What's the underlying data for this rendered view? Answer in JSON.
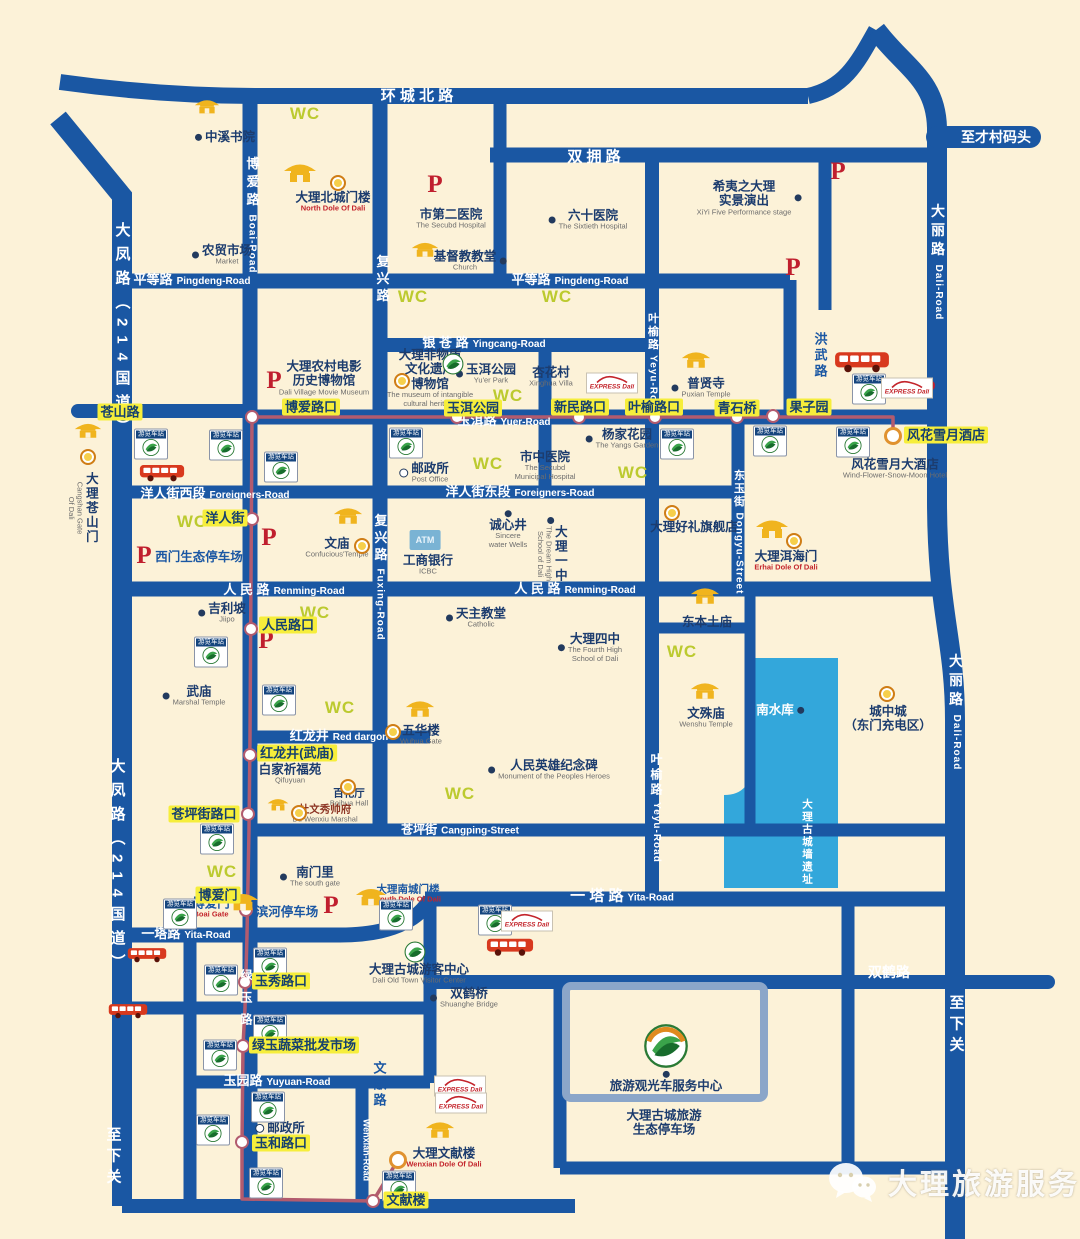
{
  "map": {
    "colors": {
      "bg": "#fcf2d8",
      "road": "#1a57a3",
      "water": "#33a7db",
      "route": "#b25b6e",
      "outline": "#8ba6c9",
      "stop_bg": "#f6ee3b",
      "stop_text": "#15406e",
      "poi": "#1c3c6e",
      "wc": "#bcca2f",
      "p": "#c01f2e",
      "gate": "#f0b41e",
      "blue_label": "#1a57a3"
    },
    "watermark": {
      "text": "大理旅游服务"
    },
    "wc_text": "WC",
    "p_text": "P",
    "atm_text": "ATM",
    "badge_text": "游览车站",
    "express_text": "EXPRESS Dali",
    "road_labels": [
      {
        "t": "环 城 北 路",
        "x": 417,
        "y": 96,
        "fs": 15
      },
      {
        "t": "双 拥 路",
        "x": 594,
        "y": 157,
        "fs": 15
      },
      {
        "t": "平等路",
        "e": "Pingdeng-Road",
        "x": 192,
        "y": 280,
        "fs": 13
      },
      {
        "t": "平等路",
        "e": "Pingdeng-Road",
        "x": 570,
        "y": 280,
        "fs": 13
      },
      {
        "t": "银 苍 路",
        "e": "Yingcang-Road",
        "x": 484,
        "y": 343,
        "fs": 13
      },
      {
        "t": "玉洱路",
        "e": "Yuer-Road",
        "x": 504,
        "y": 421,
        "fs": 13
      },
      {
        "t": "洋人街西段",
        "e": "Foreigners-Road",
        "x": 215,
        "y": 494,
        "fs": 13
      },
      {
        "t": "洋人街东段",
        "e": "Foreigners-Road",
        "x": 520,
        "y": 492,
        "fs": 13
      },
      {
        "t": "人 民 路",
        "e": "Renming-Road",
        "x": 284,
        "y": 590,
        "fs": 13
      },
      {
        "t": "人 民 路",
        "e": "Renming-Road",
        "x": 575,
        "y": 589,
        "fs": 13
      },
      {
        "t": "红龙井",
        "e": "Red dargon",
        "x": 339,
        "y": 736,
        "fs": 13
      },
      {
        "t": "苍坪街",
        "e": "Cangping-Street",
        "x": 460,
        "y": 830,
        "fs": 12
      },
      {
        "t": "一塔路",
        "e": "Yita-Road",
        "x": 186,
        "y": 934,
        "fs": 13
      },
      {
        "t": "一 塔 路",
        "e": "Yita-Road",
        "x": 622,
        "y": 896,
        "fs": 15
      },
      {
        "t": "双鹤路",
        "x": 889,
        "y": 972,
        "fs": 14
      },
      {
        "t": "玉园路",
        "e": "Yuyuan-Road",
        "x": 277,
        "y": 1081,
        "fs": 13
      },
      {
        "t": "至才村码头",
        "x": 996,
        "y": 137,
        "fs": 14
      },
      {
        "t": "博爱路",
        "e": "Boai-Road",
        "x": 252,
        "y": 215,
        "v": 1,
        "fs": 13,
        "ls": 5
      },
      {
        "t": "复兴路",
        "x": 382,
        "y": 280,
        "v": 1,
        "fs": 13,
        "ls": 4
      },
      {
        "t": "复兴路",
        "e": "Fuxing-Road",
        "x": 380,
        "y": 577,
        "v": 1,
        "fs": 13,
        "ls": 4
      },
      {
        "t": "叶榆路",
        "e": "Yeyu-Road",
        "x": 652,
        "y": 364,
        "v": 1,
        "fs": 11,
        "ls": 2
      },
      {
        "t": "叶榆路",
        "e": "Yeyu-Road",
        "x": 656,
        "y": 808,
        "v": 1,
        "fs": 12,
        "ls": 3
      },
      {
        "t": "东玉街",
        "e": "Dongyu-Street",
        "x": 738,
        "y": 532,
        "v": 1,
        "fs": 11,
        "ls": 2
      },
      {
        "t": "大丽路",
        "e": "Dali-Road",
        "x": 938,
        "y": 262,
        "v": 1,
        "fs": 14,
        "ls": 5
      },
      {
        "t": "大丽路",
        "e": "Dali-Road",
        "x": 956,
        "y": 712,
        "v": 1,
        "fs": 14,
        "ls": 5
      },
      {
        "t": "大凤路（214国道）",
        "x": 122,
        "y": 332,
        "v": 1,
        "fs": 15,
        "ls": 9
      },
      {
        "t": "大凤路（214国道）",
        "x": 117,
        "y": 868,
        "v": 1,
        "fs": 15,
        "ls": 9
      },
      {
        "t": "至下关",
        "x": 956,
        "y": 1026,
        "v": 1,
        "fs": 15,
        "ls": 6
      },
      {
        "t": "至下关",
        "x": 113,
        "y": 1158,
        "v": 1,
        "fs": 15,
        "ls": 6
      },
      {
        "t": "绿玉路",
        "x": 246,
        "y": 1002,
        "v": 1,
        "fs": 12,
        "ls": 10
      },
      {
        "t": "Wenxian-Road",
        "x": 366,
        "y": 1150,
        "v": 1,
        "fs": 9
      }
    ],
    "side_labels": [
      {
        "t": "洪武路",
        "x": 820,
        "y": 356,
        "v": 1
      },
      {
        "t": "文献路",
        "x": 379,
        "y": 1085,
        "v": 1
      }
    ],
    "stops": [
      {
        "t": "苍山路",
        "x": 120,
        "y": 412
      },
      {
        "t": "博爱路口",
        "x": 311,
        "y": 407
      },
      {
        "t": "玉洱公园",
        "x": 473,
        "y": 408
      },
      {
        "t": "新民路口",
        "x": 580,
        "y": 407
      },
      {
        "t": "叶榆路口",
        "x": 654,
        "y": 407
      },
      {
        "t": "青石桥",
        "x": 737,
        "y": 408
      },
      {
        "t": "果子园",
        "x": 809,
        "y": 407
      },
      {
        "t": "风花雪月酒店",
        "x": 946,
        "y": 435
      },
      {
        "t": "洋人街",
        "x": 225,
        "y": 518
      },
      {
        "t": "人民路口",
        "x": 288,
        "y": 625
      },
      {
        "t": "红龙井(武庙)",
        "x": 297,
        "y": 753
      },
      {
        "t": "苍坪街路口",
        "x": 204,
        "y": 814
      },
      {
        "t": "博爱门",
        "x": 218,
        "y": 895
      },
      {
        "t": "玉秀路口",
        "x": 281,
        "y": 981
      },
      {
        "t": "绿玉蔬菜批发市场",
        "x": 304,
        "y": 1045
      },
      {
        "t": "玉和路口",
        "x": 281,
        "y": 1143
      },
      {
        "t": "文献楼",
        "x": 406,
        "y": 1200
      }
    ],
    "pois": [
      {
        "t": "中溪书院",
        "x": 225,
        "y": 137,
        "m": "dot",
        "s": "l"
      },
      {
        "t": "农贸市场",
        "e": "Market",
        "x": 222,
        "y": 255,
        "m": "dot",
        "s": "l"
      },
      {
        "t": "大理北城门楼",
        "e": "North Dole Of Dali",
        "x": 333,
        "y": 202,
        "c": "enred"
      },
      {
        "t": "市第二医院",
        "e": "The Secubd Hospital",
        "x": 451,
        "y": 219
      },
      {
        "t": "六十医院",
        "e": "The Sixtieth Hospital",
        "x": 588,
        "y": 220,
        "m": "dot",
        "s": "l"
      },
      {
        "t": "基督教教堂",
        "e": "Church",
        "x": 470,
        "y": 261,
        "m": "dot",
        "s": "r"
      },
      {
        "t": "希夷之大理\n实景演出",
        "e": "XiYi Five Performance stage",
        "x": 749,
        "y": 198,
        "m": "dot",
        "s": "r"
      },
      {
        "t": "大理农村电影\n历史博物馆",
        "e": "Dali Village Movie Museum",
        "x": 324,
        "y": 378
      },
      {
        "t": "大理非物质\n文化遗产\n博物馆",
        "e": "The museum of intangible\ncultural heritage",
        "x": 430,
        "y": 378
      },
      {
        "t": "玉洱公园",
        "e": "Yu'er Park",
        "x": 486,
        "y": 374,
        "m": "dot",
        "s": "l"
      },
      {
        "t": "杏花村",
        "e": "Xinghua Villa",
        "x": 551,
        "y": 377
      },
      {
        "t": "普贤寺",
        "e": "Puxian Temple",
        "x": 701,
        "y": 388,
        "m": "dot",
        "s": "l"
      },
      {
        "t": "杨家花园",
        "e": "The Yangs Garden",
        "x": 622,
        "y": 439,
        "m": "dot",
        "s": "l"
      },
      {
        "t": "市中医院",
        "e": "The Secubd\nMunicipal Hospital",
        "x": 545,
        "y": 466
      },
      {
        "t": "邮政所",
        "e": "Post Office",
        "x": 424,
        "y": 473,
        "m": "circ",
        "s": "l"
      },
      {
        "t": "文庙",
        "e": "Confucious'Temple",
        "x": 337,
        "y": 548
      },
      {
        "t": "工商银行",
        "e": "ICBC",
        "x": 428,
        "y": 565
      },
      {
        "t": "诚心井",
        "e": "Sincere\nwater Wells",
        "x": 508,
        "y": 530,
        "m": "dot",
        "s": "t"
      },
      {
        "t": "大理一中",
        "e": "The Dream High\nSchool of Dali",
        "x": 551,
        "y": 550,
        "c": "vert",
        "m": "dot",
        "s": "t"
      },
      {
        "t": "大理好礼旗舰店",
        "x": 694,
        "y": 527
      },
      {
        "t": "大理洱海门",
        "e": "Erhai Dole Of Dali",
        "x": 786,
        "y": 561,
        "c": "enred"
      },
      {
        "t": "风花雪月大酒店",
        "e": "Wind-Flower-Snow-Moon Hotel",
        "x": 895,
        "y": 469
      },
      {
        "t": "吉利坡",
        "e": "Jiipo",
        "x": 222,
        "y": 613,
        "m": "dot",
        "s": "l"
      },
      {
        "t": "武庙",
        "e": "Marshal Temple",
        "x": 194,
        "y": 696,
        "m": "dot",
        "s": "l"
      },
      {
        "t": "天主教堂",
        "e": "Catholic",
        "x": 476,
        "y": 618,
        "m": "dot",
        "s": "l"
      },
      {
        "t": "大理四中",
        "e": "The Fourth High\nSchool of Dali",
        "x": 590,
        "y": 648,
        "m": "dot",
        "s": "l"
      },
      {
        "t": "东本土庙",
        "x": 707,
        "y": 622
      },
      {
        "t": "文殊庙",
        "e": "Wenshu Temple",
        "x": 706,
        "y": 718
      },
      {
        "t": "南水库",
        "x": 780,
        "y": 710,
        "c": "white",
        "m": "dot",
        "s": "r"
      },
      {
        "t": "城中城\n（东门充电区）",
        "x": 888,
        "y": 719
      },
      {
        "t": "人民英雄纪念碑",
        "e": "Monument of the Peoples Heroes",
        "x": 549,
        "y": 770,
        "m": "dot",
        "s": "l"
      },
      {
        "t": "白家祈福苑",
        "e": "Qifuyuan",
        "x": 290,
        "y": 774
      },
      {
        "t": "百花厅",
        "e": "Boihua Hall",
        "x": 349,
        "y": 798,
        "c": "small"
      },
      {
        "t": "杜文秀帅府",
        "e": "Du Wenxiu Marshal",
        "x": 325,
        "y": 814,
        "c": "small darkred"
      },
      {
        "t": "五华楼",
        "e": "Wuhua Gate",
        "x": 421,
        "y": 735
      },
      {
        "t": "南门里",
        "e": "The south gate",
        "x": 310,
        "y": 877,
        "m": "dot",
        "s": "l"
      },
      {
        "t": "大理南城门楼",
        "e": "South Dole Of Dali",
        "x": 408,
        "y": 894,
        "c": "blue small enred"
      },
      {
        "t": "大理古城游客中心",
        "e": "Dali Old Town Visitor Center",
        "x": 419,
        "y": 970,
        "m": "dot",
        "s": "t"
      },
      {
        "t": "双鹤桥",
        "e": "Shuanghe Bridge",
        "x": 464,
        "y": 998,
        "m": "dot",
        "s": "l"
      },
      {
        "t": "旅游观光车服务中心",
        "x": 666,
        "y": 1082,
        "m": "dot",
        "s": "t"
      },
      {
        "t": "大理古城旅游\n生态停车场",
        "x": 664,
        "y": 1123
      },
      {
        "t": "邮政所",
        "x": 280,
        "y": 1128,
        "m": "circ",
        "s": "l"
      },
      {
        "t": "大理文献楼",
        "e": "Wenxian Dole Of Dali",
        "x": 444,
        "y": 1158,
        "c": "enred"
      },
      {
        "t": "大理苍山门",
        "e": "Cangshan Gate\nOf Dali",
        "x": 82,
        "y": 508,
        "c": "vert"
      },
      {
        "t": "大理古城墙遗址",
        "x": 807,
        "y": 842,
        "c": "vert white small"
      },
      {
        "t": "滨河停车场",
        "x": 287,
        "y": 912,
        "c": "blue"
      },
      {
        "t": "西门生态停车场",
        "x": 199,
        "y": 557,
        "c": "blue"
      },
      {
        "t": "博爱门",
        "e": "Boai Gate",
        "x": 211,
        "y": 908,
        "c": "blue enred"
      }
    ],
    "wc": [
      [
        305,
        114
      ],
      [
        413,
        297
      ],
      [
        557,
        297
      ],
      [
        508,
        396
      ],
      [
        192,
        522
      ],
      [
        488,
        464
      ],
      [
        633,
        473
      ],
      [
        682,
        652
      ],
      [
        315,
        613
      ],
      [
        340,
        708
      ],
      [
        460,
        794
      ],
      [
        222,
        872
      ]
    ],
    "parking": [
      [
        435,
        185
      ],
      [
        793,
        268
      ],
      [
        838,
        172
      ],
      [
        928,
        390
      ],
      [
        274,
        381
      ],
      [
        144,
        556
      ],
      [
        269,
        538
      ],
      [
        266,
        641
      ],
      [
        331,
        906
      ]
    ],
    "gates": [
      [
        207,
        106,
        26
      ],
      [
        300,
        172,
        34
      ],
      [
        425,
        249,
        28
      ],
      [
        696,
        359,
        30
      ],
      [
        348,
        515,
        30
      ],
      [
        772,
        528,
        34
      ],
      [
        705,
        595,
        30
      ],
      [
        705,
        690,
        30
      ],
      [
        420,
        708,
        30
      ],
      [
        278,
        804,
        22
      ],
      [
        243,
        901,
        32
      ],
      [
        371,
        896,
        32
      ],
      [
        440,
        1129,
        30
      ],
      [
        88,
        430,
        28
      ]
    ],
    "targets": [
      [
        338,
        183
      ],
      [
        402,
        381
      ],
      [
        362,
        546
      ],
      [
        794,
        541
      ],
      [
        88,
        457
      ],
      [
        348,
        787
      ],
      [
        299,
        813
      ],
      [
        393,
        732
      ],
      [
        887,
        694
      ],
      [
        672,
        513
      ]
    ],
    "badges": [
      [
        151,
        444
      ],
      [
        226,
        445
      ],
      [
        406,
        443
      ],
      [
        281,
        467
      ],
      [
        677,
        444
      ],
      [
        770,
        441
      ],
      [
        853,
        442
      ],
      [
        869,
        389
      ],
      [
        211,
        652
      ],
      [
        279,
        700
      ],
      [
        217,
        839
      ],
      [
        180,
        914
      ],
      [
        396,
        915
      ],
      [
        495,
        920
      ],
      [
        221,
        980
      ],
      [
        270,
        963
      ],
      [
        270,
        1030
      ],
      [
        220,
        1055
      ],
      [
        268,
        1107
      ],
      [
        213,
        1130
      ],
      [
        266,
        1183
      ],
      [
        399,
        1186
      ]
    ],
    "express": [
      [
        612,
        383
      ],
      [
        907,
        388
      ],
      [
        527,
        921
      ],
      [
        460,
        1086
      ],
      [
        461,
        1103
      ]
    ],
    "buses": [
      [
        162,
        473,
        46
      ],
      [
        862,
        362,
        56
      ],
      [
        147,
        955,
        40
      ],
      [
        510,
        947,
        48
      ],
      [
        128,
        1011,
        40
      ]
    ],
    "logos": [
      [
        453,
        364
      ],
      [
        415,
        952
      ]
    ],
    "big_logo": [
      666,
      1046
    ],
    "route": {
      "dots": [
        [
          252,
          417
        ],
        [
          457,
          417
        ],
        [
          579,
          417
        ],
        [
          655,
          417
        ],
        [
          737,
          417
        ],
        [
          773,
          416
        ],
        [
          252,
          519
        ],
        [
          251,
          629
        ],
        [
          250,
          755
        ],
        [
          248,
          814
        ],
        [
          246,
          910
        ],
        [
          245,
          982
        ],
        [
          243,
          1046
        ],
        [
          242,
          1142
        ],
        [
          373,
          1201
        ]
      ],
      "ends": [
        [
          893,
          436
        ],
        [
          398,
          1160
        ]
      ]
    }
  }
}
